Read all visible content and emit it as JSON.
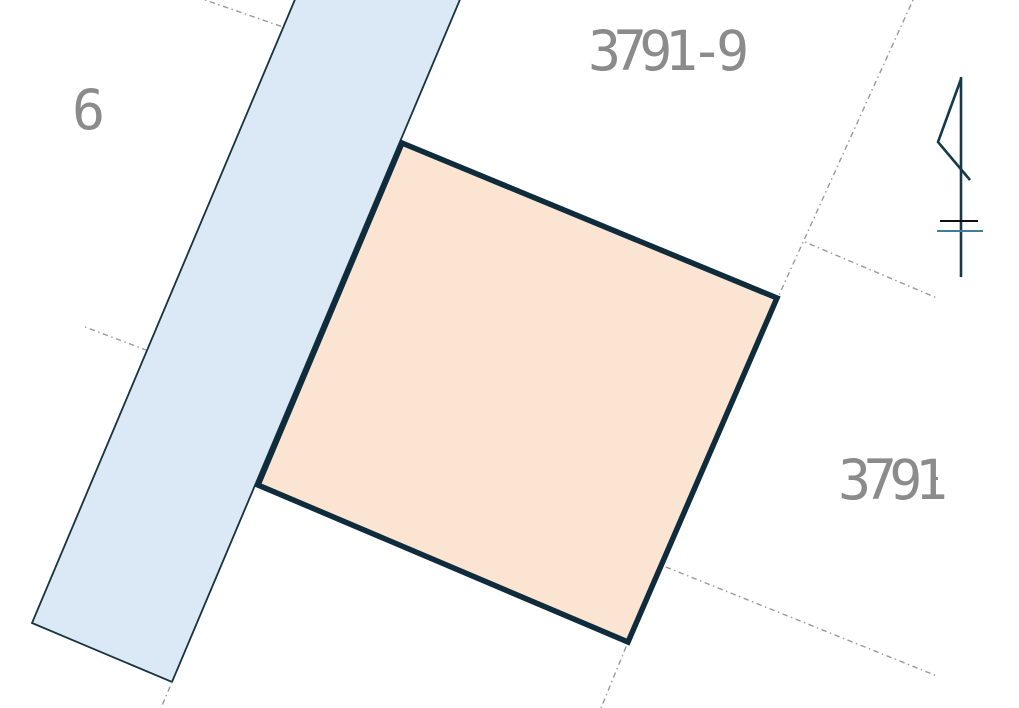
{
  "map": {
    "type": "cadastral-parcel-map",
    "colors": {
      "background": "#ffffff",
      "road_strip_fill": "#dbe8f6",
      "road_strip_stroke": "#16333e",
      "highlighted_parcel_fill": "#fce4d2",
      "highlighted_parcel_stroke": "#0f2c3c",
      "boundary_dotted_gray": "#9a9a9a",
      "label_gray": "#8b8b8b",
      "flag_navy": "#16394a",
      "bar_black": "#101010",
      "bar_blue": "#3f7e9a"
    },
    "labels": {
      "top_parcel": "3791-9",
      "right_parcel": "3791",
      "right_parcel_suffix_partial": "-",
      "left_parcel_partial": "6"
    },
    "shapes": {
      "road_strip": {
        "points": "299,-10 464,-10 172,682 32,623"
      },
      "highlighted_parcel": {
        "points": "402,143 777,298 628,642 258,485"
      },
      "boundary_top_left": {
        "points": "205,0 283,27"
      },
      "boundary_mid_left": {
        "points": "85,327 146,350"
      },
      "boundary_long_right": {
        "points": "913,0 779,295"
      },
      "boundary_branch_right": {
        "points": "805,242 937,298"
      },
      "boundary_lower_right": {
        "points": "661,565 937,676"
      },
      "boundary_below_parcel": {
        "points": "628,642 601,708"
      },
      "boundary_below_strip": {
        "points": "172,682 161,708"
      }
    },
    "flag_symbol": {
      "zigzag": {
        "points": "961,79 938,142 970,180"
      },
      "pole": {
        "points": "961,77 961,277"
      },
      "black_bar": {
        "points": "940,221 978,221"
      },
      "blue_bar": {
        "points": "937,231 983,231"
      }
    }
  }
}
